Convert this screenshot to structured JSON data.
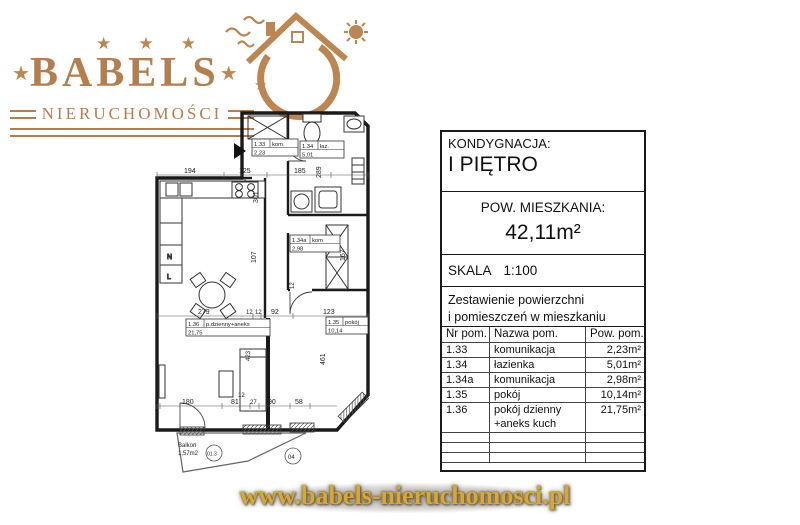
{
  "logo": {
    "brand": "BABELS",
    "subtitle": "NIERUCHOMOŚCI",
    "star": "★"
  },
  "panel": {
    "floor_label": "KONDYGNACJA:",
    "floor_value": "I PIĘTRO",
    "area_label": "POW. MIESZKANIA:",
    "area_value": "42,11m²",
    "scale_label": "SKALA",
    "scale_value": "1:100",
    "summary_line1": "Zestawienie powierzchni",
    "summary_line2": "i pomieszczeń w mieszkaniu",
    "col_nr": "Nr pom.",
    "col_name": "Nazwa pom.",
    "col_area": "Pow. pom.",
    "rows": [
      {
        "nr": "1.33",
        "name": "komunikacja",
        "area": "2,23m²"
      },
      {
        "nr": "1.34",
        "name": "łazienka",
        "area": "5,01m²"
      },
      {
        "nr": "1.34a",
        "name": "komunikacja",
        "area": "2,98m²"
      },
      {
        "nr": "1.35",
        "name": "pokój",
        "area": "10,14m²"
      },
      {
        "nr": "1.36",
        "name": "pokój dzienny +aneks kuch",
        "area": "21,75m²"
      }
    ]
  },
  "plan": {
    "tags": [
      {
        "nr": "1.33",
        "name": "kom.",
        "area": "2,23"
      },
      {
        "nr": "1.34",
        "name": "łaz.",
        "area": "5,01"
      },
      {
        "nr": "1.34a",
        "name": "kom",
        "area": "2,98"
      },
      {
        "nr": "1.36",
        "name": "p.dzienny+aneks",
        "area": "21,75"
      },
      {
        "nr": "1.35",
        "name": "pokój",
        "area": "10,14"
      }
    ],
    "balcony_line1": "Balkon",
    "balcony_line2": "1,57m2",
    "dims": {
      "top": [
        "194",
        "125",
        "185"
      ],
      "mid": [
        "279",
        "12",
        "12",
        "92",
        "123"
      ],
      "bottom": [
        "8",
        "180",
        "81",
        "27",
        "90",
        "58"
      ],
      "v301": "301",
      "v289": "289",
      "v107": "107",
      "v167": "167",
      "v461": "461",
      "v423": "423",
      "v12": "12",
      "small12": "12"
    },
    "markers": {
      "m1": "01.3",
      "m2": "04"
    }
  },
  "footer": {
    "url": "www.babels-nieruchomosci.pl"
  }
}
